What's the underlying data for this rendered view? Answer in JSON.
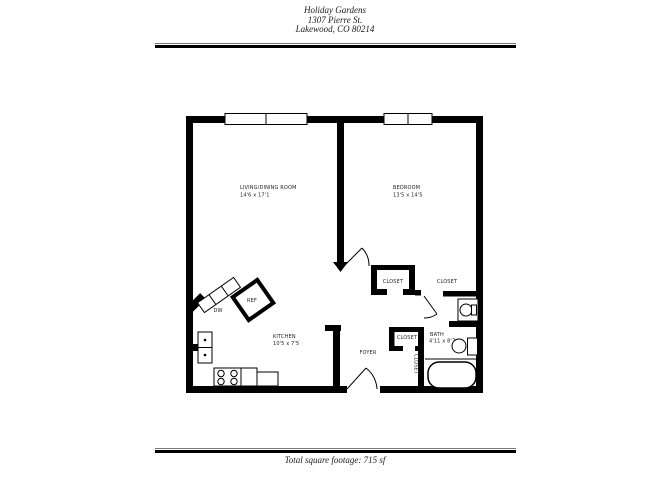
{
  "header": {
    "property_name": "Holiday Gardens",
    "address_line1": "1307 Pierre St.",
    "address_line2": "Lakewood, CO 80214"
  },
  "floorplan": {
    "rooms": {
      "living_dining": {
        "name": "LIVING/DINING ROOM",
        "dims": "14'6 x 17'1"
      },
      "bedroom": {
        "name": "BEDROOM",
        "dims": "13'5 x 14'5"
      },
      "kitchen": {
        "name": "KITCHEN",
        "dims": "10'5 x 7'5"
      },
      "bath": {
        "name": "BATH",
        "dims": "4'11 x 8'7"
      },
      "foyer": {
        "name": "FOYER"
      },
      "bedroom_closet": {
        "name": "CLOSET"
      },
      "bedroom_closet_2": {
        "name": "CLOSET"
      },
      "foyer_closet": {
        "name": "CLOSET"
      },
      "hall_closet": {
        "name": "CLOSET"
      }
    },
    "fixtures": {
      "refrigerator": "REF",
      "dishwasher": "DW"
    },
    "colors": {
      "wall": "#000000",
      "background": "#ffffff",
      "label": "#222222"
    }
  },
  "footer": {
    "total_square_footage": "Total square footage: 715 sf"
  }
}
